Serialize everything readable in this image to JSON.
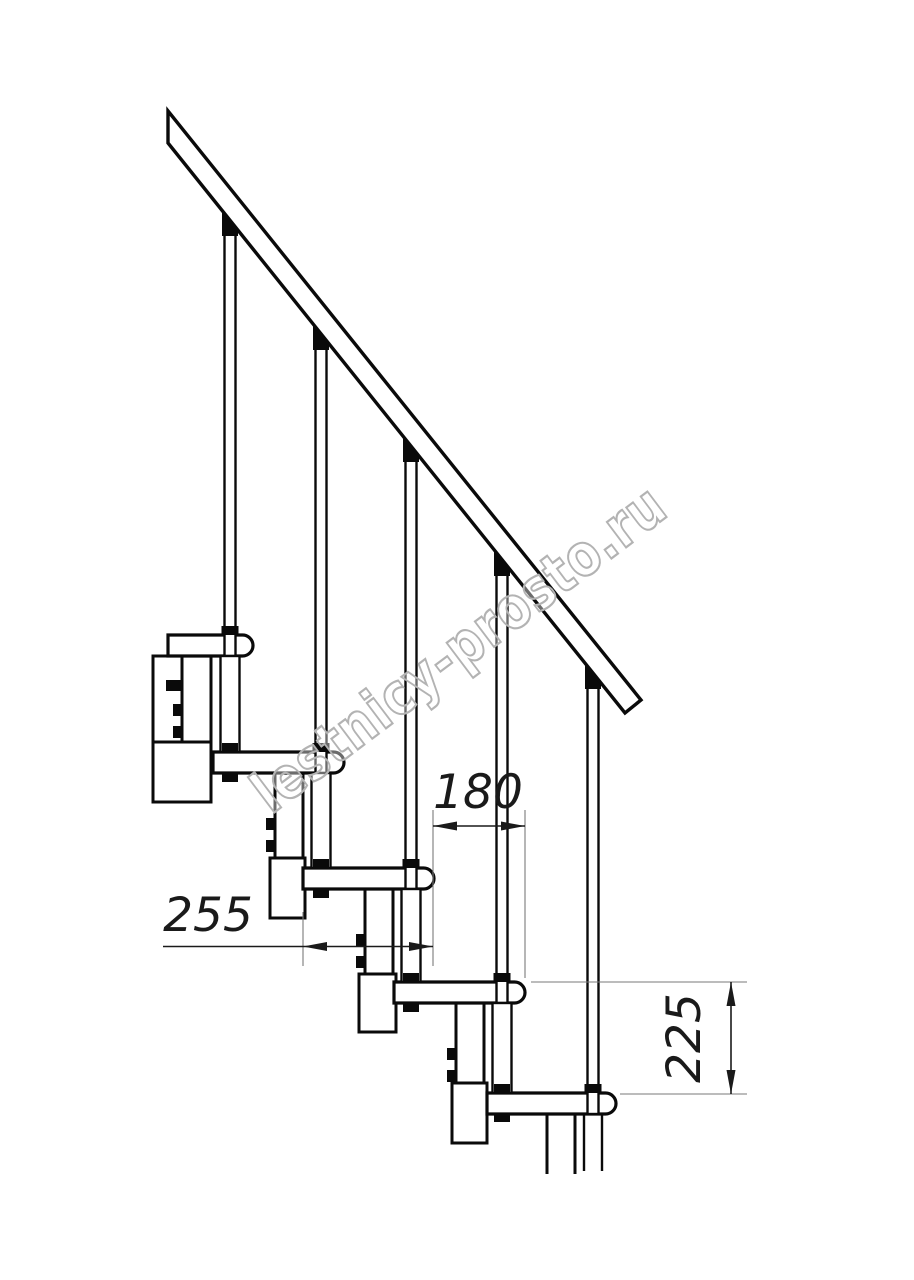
{
  "drawing": {
    "title": "modular staircase side-view technical drawing",
    "watermark": "lestnicy-prosto.ru",
    "dimensions": {
      "step_run": "180",
      "tread_depth": "255",
      "step_rise": "225"
    },
    "colors": {
      "ink": "#0a0a0a",
      "dim_line": "#1a1a1a",
      "extension_line": "#7a7a7a",
      "watermark_stroke": "#b3b3b3",
      "background": "#ffffff"
    }
  }
}
